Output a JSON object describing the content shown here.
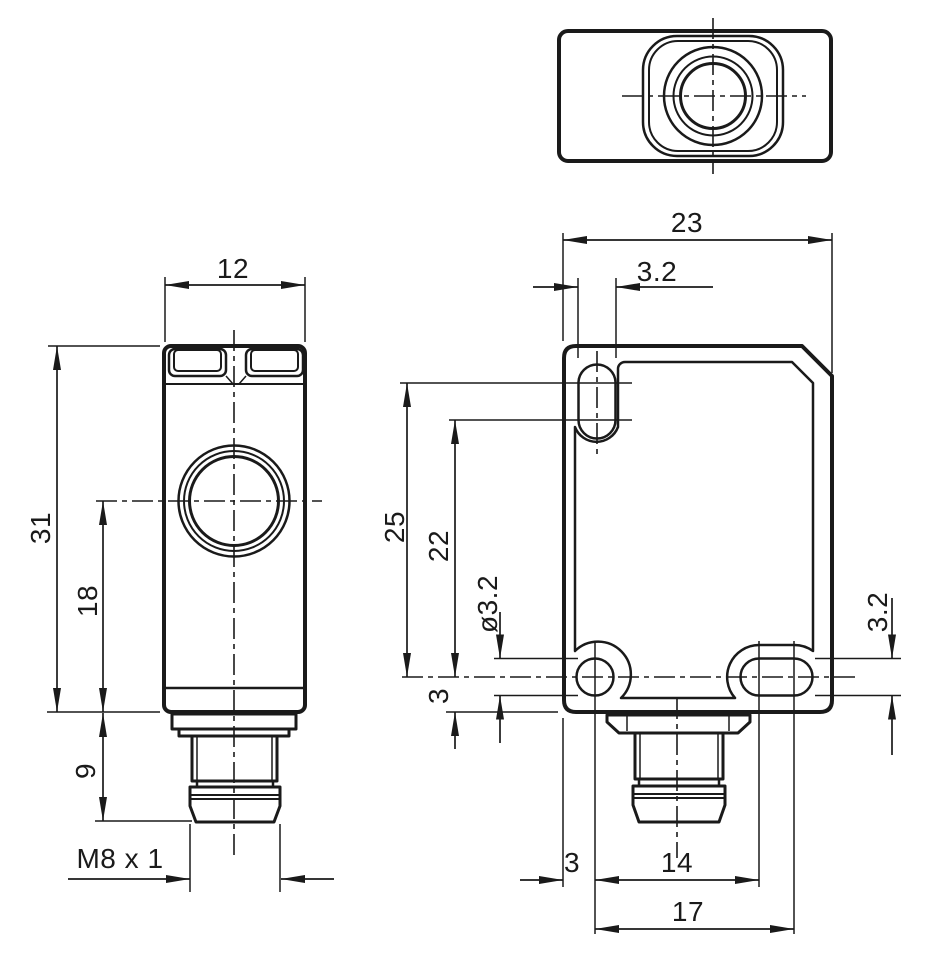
{
  "drawing": {
    "background": "#ffffff",
    "line_color": "#1a1a1a",
    "views": {
      "top_view": "top view",
      "side_view": "side view",
      "front_view": "front view"
    },
    "dimensions": {
      "side": {
        "width": "12",
        "height": "31",
        "axis_to_bottom": "18",
        "connector_length": "9",
        "thread": "M8 x 1"
      },
      "front": {
        "width": "23",
        "slot_width": "3.2",
        "slot_upper_arc_to_axis": "25",
        "slot_lower_arc_to_axis": "22",
        "hole_diameter": "ø3.2",
        "axis_to_bottom": "3",
        "side_slot_width": "3.2",
        "edge_to_hole": "3",
        "hole_to_slot": "14",
        "hole_to_slot_far": "17"
      }
    }
  }
}
